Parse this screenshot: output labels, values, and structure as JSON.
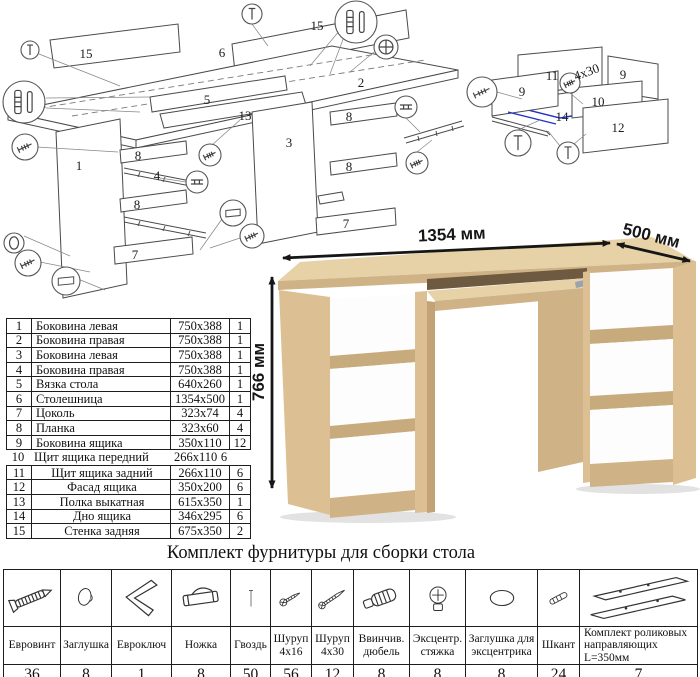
{
  "colors": {
    "wood": "#dcc094",
    "wood_light": "#e6d2a6",
    "wood_med": "#cfb285",
    "wood_dark": "#c2a376",
    "highlight_blue": "#2233cc"
  },
  "assembly": {
    "main_diagram": {
      "part_labels": [
        {
          "t": "15",
          "x": 86,
          "y": 58
        },
        {
          "t": "6",
          "x": 222,
          "y": 57
        },
        {
          "t": "15",
          "x": 317,
          "y": 30
        },
        {
          "t": "2",
          "x": 361,
          "y": 87
        },
        {
          "t": "5",
          "x": 207,
          "y": 104
        },
        {
          "t": "13",
          "x": 245,
          "y": 120
        },
        {
          "t": "3",
          "x": 289,
          "y": 147
        },
        {
          "t": "1",
          "x": 79,
          "y": 170
        },
        {
          "t": "8",
          "x": 138,
          "y": 160
        },
        {
          "t": "4",
          "x": 157,
          "y": 180
        },
        {
          "t": "8",
          "x": 137,
          "y": 209
        },
        {
          "t": "7",
          "x": 135,
          "y": 259
        },
        {
          "t": "8",
          "x": 349,
          "y": 121
        },
        {
          "t": "8",
          "x": 349,
          "y": 171
        },
        {
          "t": "7",
          "x": 346,
          "y": 228
        }
      ],
      "callouts": [
        {
          "icon": "nail-icon",
          "x": 30,
          "y": 50,
          "r": 9
        },
        {
          "icon": "nail-icon",
          "x": 252,
          "y": 14,
          "r": 10
        },
        {
          "icon": "dowel-shkant-icon",
          "x": 24,
          "y": 102,
          "r": 21
        },
        {
          "icon": "dowel-shkant-icon",
          "x": 356,
          "y": 22,
          "r": 21
        },
        {
          "icon": "cam-lock-icon",
          "x": 386,
          "y": 47,
          "r": 12
        },
        {
          "icon": "eurobolt-icon",
          "x": 25,
          "y": 147,
          "r": 13
        },
        {
          "icon": "cap-icon",
          "x": 14,
          "y": 243,
          "r": 10
        },
        {
          "icon": "eurobolt-icon",
          "x": 28,
          "y": 263,
          "r": 13
        },
        {
          "icon": "foot-icon",
          "x": 66,
          "y": 281,
          "r": 14
        },
        {
          "icon": "eurobolt-icon",
          "x": 210,
          "y": 155,
          "r": 11
        },
        {
          "icon": "rail-icon",
          "x": 197,
          "y": 182,
          "r": 11
        },
        {
          "icon": "foot-icon",
          "x": 233,
          "y": 213,
          "r": 13
        },
        {
          "icon": "screw-icon",
          "x": 252,
          "y": 236,
          "r": 12
        },
        {
          "icon": "rail-icon",
          "x": 406,
          "y": 107,
          "r": 11
        },
        {
          "icon": "screw-icon",
          "x": 417,
          "y": 163,
          "r": 11
        }
      ]
    },
    "drawer_diagram": {
      "part_labels": [
        {
          "t": "11",
          "x": 552,
          "y": 80
        },
        {
          "t": "9",
          "x": 623,
          "y": 79
        },
        {
          "t": "9",
          "x": 522,
          "y": 96
        },
        {
          "t": "10",
          "x": 598,
          "y": 106
        },
        {
          "t": "14",
          "x": 562,
          "y": 121
        },
        {
          "t": "12",
          "x": 618,
          "y": 132
        },
        {
          "t": "4x30",
          "x": 588,
          "y": 76,
          "rot": -20
        }
      ],
      "callouts": [
        {
          "icon": "eurobolt-icon",
          "x": 482,
          "y": 92,
          "r": 15
        },
        {
          "icon": "screw-icon",
          "x": 570,
          "y": 83,
          "r": 10
        },
        {
          "icon": "nail-icon",
          "x": 518,
          "y": 143,
          "r": 13
        },
        {
          "icon": "nail-icon",
          "x": 568,
          "y": 153,
          "r": 11
        }
      ]
    }
  },
  "parts_table": {
    "segment1": [
      [
        "1",
        "Боковина левая",
        "750x388",
        "1"
      ],
      [
        "2",
        "Боковина правая",
        "750x388",
        "1"
      ],
      [
        "3",
        "Боковина левая",
        "750x388",
        "1"
      ],
      [
        "4",
        "Боковина правая",
        "750x388",
        "1"
      ],
      [
        "5",
        "Вязка стола",
        "640x260",
        "1"
      ],
      [
        "6",
        "Столешница",
        "1354x500",
        "1"
      ],
      [
        "7",
        "Цоколь",
        "323x74",
        "4"
      ],
      [
        "8",
        "Планка",
        "323x60",
        "4"
      ],
      [
        "9",
        "Боковина ящика",
        "350x110",
        "12"
      ]
    ],
    "segment2": [
      [
        "10",
        "Щит ящика передний",
        "266x110",
        "6"
      ]
    ],
    "segment3": [
      [
        "11",
        "Щит ящика задний",
        "266x110",
        "6"
      ],
      [
        "12",
        "Фасад ящика",
        "350x200",
        "6"
      ],
      [
        "13",
        "Полка выкатная",
        "615x350",
        "1"
      ],
      [
        "14",
        "Дно ящика",
        "346x295",
        "6"
      ],
      [
        "15",
        "Стенка задняя",
        "675x350",
        "2"
      ]
    ]
  },
  "product": {
    "dimensions": {
      "width": "1354 мм",
      "depth": "500 мм",
      "height": "766 мм"
    }
  },
  "hardware": {
    "title": "Комплект фурнитуры для сборки стола",
    "items": [
      {
        "icon": "eurobolt-icon",
        "label": "Евровинт",
        "qty": "36"
      },
      {
        "icon": "cap-icon",
        "label": "Заглушка",
        "qty": "8"
      },
      {
        "icon": "hexkey-icon",
        "label": "Евроключ",
        "qty": "1"
      },
      {
        "icon": "foot-icon",
        "label": "Ножка",
        "qty": "8"
      },
      {
        "icon": "nail-icon",
        "label": "Гвоздь",
        "qty": "50"
      },
      {
        "icon": "screw-icon",
        "label": "Шуруп 4x16",
        "qty": "56"
      },
      {
        "icon": "screw-long-icon",
        "label": "Шуруп 4x30",
        "qty": "12"
      },
      {
        "icon": "dowel-icon",
        "label": "Ввинчив. дюбель",
        "qty": "8"
      },
      {
        "icon": "cam-lock-icon",
        "label": "Эксцентр. стяжка",
        "qty": "8"
      },
      {
        "icon": "cam-cap-icon",
        "label": "Заглушка для эксцентрика",
        "qty": "8"
      },
      {
        "icon": "shkant-icon",
        "label": "Шкант",
        "qty": "24"
      },
      {
        "icon": "rails-icon",
        "label": "Комплект роликовых направляющих L=350мм",
        "qty": "7"
      }
    ]
  }
}
